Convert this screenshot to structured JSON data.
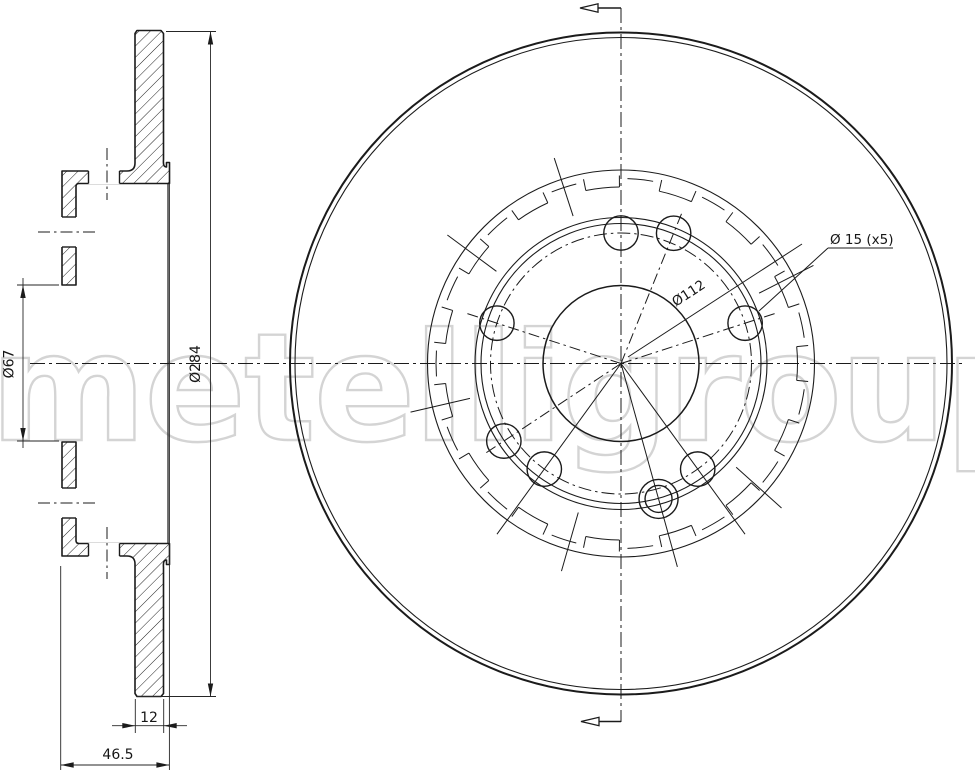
{
  "watermark": {
    "text": "metelligroup",
    "color": "#d4d4d4"
  },
  "labels": {
    "outer_diameter": "Ø284",
    "bore_diameter": "Ø67",
    "thickness": "12",
    "overall_height": "46.5",
    "pitch_circle": "Ø112",
    "bolt_holes": "Ø 15 (x5)"
  },
  "colors": {
    "line": "#1b1b1b",
    "thin_line": "#262626",
    "background": "#ffffff",
    "watermark": "#d4d4d4"
  },
  "geometry": {
    "cx": 621,
    "cy": 363.5,
    "outer_r": 331,
    "outer_r2": 326,
    "hat_ring_r": 193.5,
    "notch_arc_r": 176.5,
    "notch_stub_r": 188,
    "notch_half_deg": 5.5,
    "dash_ring_r": 185,
    "ring_r1": 146,
    "ring_r2": 140,
    "pcd_r": 130.5,
    "pcd2_r": 140.5,
    "hub_r": 78,
    "hole_r": 17.2,
    "holes_a_angles": [
      18,
      90,
      162,
      234,
      306
    ],
    "holes_b_angles": [
      68,
      213.5
    ],
    "hole_double": {
      "angle": 285.5,
      "r_inner": 13.5,
      "r_outer": 19.5
    },
    "dashdot_spoke_angles": [
      18,
      68,
      162,
      213.5
    ],
    "dashdot_spoke_len": 162,
    "solid_spoke_angles": [
      234,
      285.5,
      306
    ],
    "solid_spoke_len": 211,
    "tick_angles": [
      27,
      108,
      143.5,
      193,
      254,
      318
    ],
    "tick_r1": 155,
    "tick_r2": 216,
    "brackets": {
      "count": 15,
      "start": 96,
      "step": 24
    },
    "h_centerline": [
      30,
      363.5,
      962,
      363.5
    ],
    "v_centerline": [
      621,
      8,
      621,
      722
    ]
  },
  "front": {
    "section_arrow_top": {
      "line": [
        621,
        8,
        598,
        8
      ],
      "tri": "598,3.8 598,12.2 580,8"
    },
    "section_arrow_bottom": {
      "line": [
        621,
        721.5,
        599,
        721.5
      ],
      "tri": "599,717.3 599,725.7 581,721.5"
    },
    "pcd_leader": [
      628,
      357,
      802,
      244
    ],
    "pcd_label_pos": [
      691,
      297
    ],
    "pcd_label_rot": -33,
    "holes_leader": [
      828,
      248,
      759,
      311
    ],
    "holes_underline": [
      828,
      248,
      893,
      248
    ],
    "holes_label_pos": [
      830,
      244
    ]
  },
  "section": {
    "top_path": "M137,30.5 L161,30.5 L163.5,33.5 L163.5,159.5 C163,166 164.5,167 166.5,167 L166.5,162.5 L169.5,162.5 L169.5,183.5 L79,183.5 Q76,183.5 76,186.5 L76,285 L62,285 L62,171 L127,171 Q135,171 135,163 L135,33.5 Z",
    "bottom_path": "M137,696.5 L161,696.5 L163.5,693.5 L163.5,567.5 C163,561 164.5,560 166.5,560 L166.5,564.5 L169.5,564.5 L169.5,543.5 L79,543.5 Q76,543.5 76,540.5 L76,442 L62,442 L62,556 L127,556 Q135,556 135,564 L135,693.5 Z",
    "gap_rects": [
      [
        88.5,
        169.6,
        31,
        14.6
      ],
      [
        88.5,
        542.8,
        31,
        14.6
      ],
      [
        60.8,
        217,
        16.4,
        30
      ],
      [
        60.8,
        488,
        16.4,
        30
      ]
    ],
    "gap_edges": [
      [
        88.5,
        171,
        88.5,
        183.5
      ],
      [
        119.5,
        171,
        119.5,
        183.5
      ],
      [
        88.5,
        543.5,
        88.5,
        556
      ],
      [
        119.5,
        543.5,
        119.5,
        556
      ],
      [
        62,
        217,
        76,
        217
      ],
      [
        62,
        247,
        76,
        247
      ],
      [
        62,
        488,
        76,
        488
      ],
      [
        62,
        518,
        76,
        518
      ]
    ],
    "dashdot_marks": [
      [
        38,
        232,
        96,
        232
      ],
      [
        38,
        503,
        96,
        503
      ],
      [
        107,
        148,
        107,
        200
      ],
      [
        107,
        527,
        107,
        579
      ]
    ],
    "rim_line": [
      168,
      183.5,
      168,
      543.5
    ],
    "dims": {
      "d284": {
        "ext": [
          [
            166,
            31.5,
            216,
            31.5
          ],
          [
            137,
            696.5,
            216,
            696.5
          ]
        ],
        "line": [
          210.5,
          31.5,
          210.5,
          696.5
        ],
        "arrows": [
          [
            210.5,
            31.5,
            90
          ],
          [
            210.5,
            696.5,
            270
          ]
        ],
        "label_pos": [
          200,
          364
        ],
        "rot": -90
      },
      "d67": {
        "ext": [
          [
            59,
            285,
            17,
            285
          ],
          [
            59,
            441,
            17,
            441
          ]
        ],
        "line": [
          23,
          278,
          23,
          448
        ],
        "arrows": [
          [
            23,
            285,
            90
          ],
          [
            23,
            441,
            270
          ]
        ],
        "label_pos": [
          13.5,
          364
        ],
        "rot": -90
      },
      "d12": {
        "ext": [
          [
            135.3,
            699,
            135.3,
            733
          ],
          [
            163.7,
            699,
            163.7,
            733
          ]
        ],
        "line": [
          112,
          725.7,
          187,
          725.7
        ],
        "arrows": [
          [
            135.3,
            725.7,
            0
          ],
          [
            163.7,
            725.7,
            180
          ]
        ],
        "label_pos": [
          149,
          722
        ]
      },
      "d465": {
        "ext": [
          [
            60.7,
            566,
            60.7,
            770
          ],
          [
            169.4,
            183.5,
            169.4,
            770
          ]
        ],
        "line": [
          60.7,
          765,
          169.4,
          765
        ],
        "arrows": [
          [
            60.7,
            765,
            180
          ],
          [
            169.4,
            765,
            0
          ]
        ],
        "label_pos": [
          118,
          759
        ]
      }
    }
  }
}
